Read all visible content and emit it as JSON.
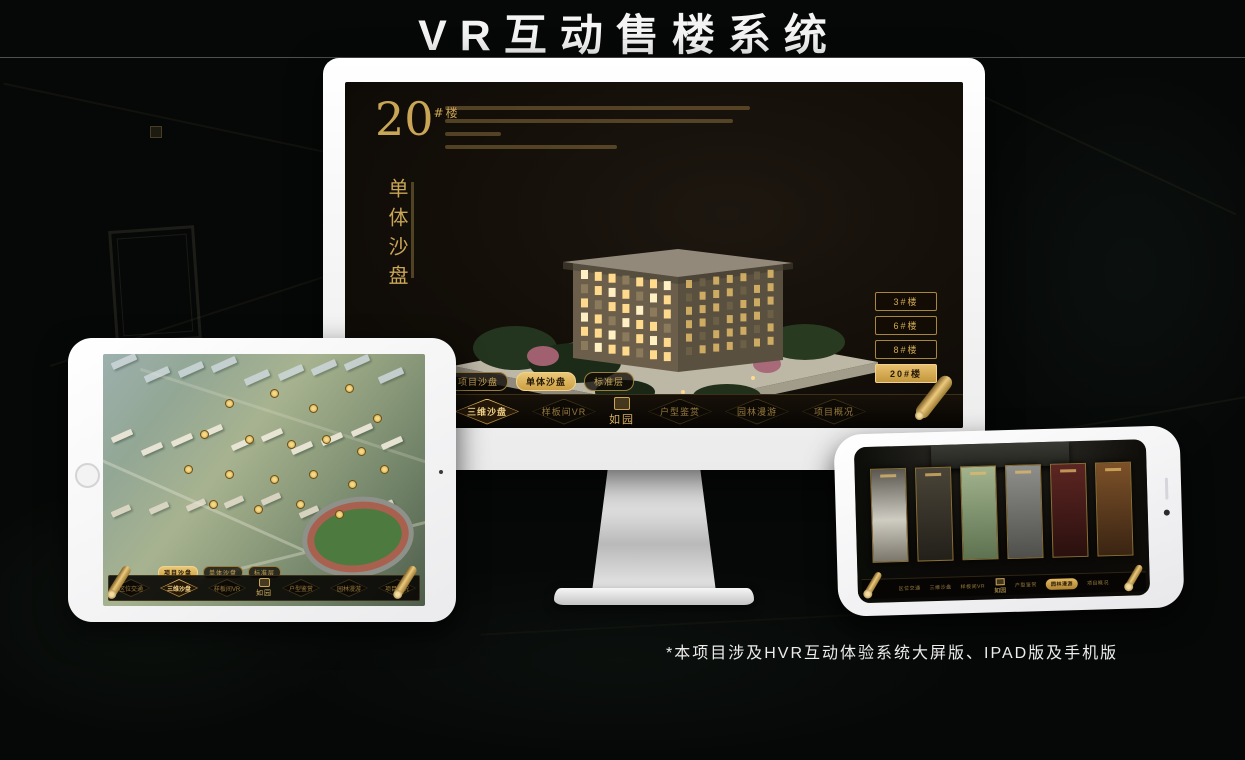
{
  "page": {
    "title": "VR互动售楼系统",
    "footnote": "*本项目涉及HVR互动体验系统大屏版、IPAD版及手机版"
  },
  "colors": {
    "gold": "#d2a94f",
    "gold_active_bg": "#e8bf6e",
    "screen_bg": "#130e08"
  },
  "monitor": {
    "headline_number": "20",
    "headline_suffix": "#楼",
    "headline_vertical": "单体沙盘",
    "building_buttons": [
      {
        "label": "3#楼",
        "active": false
      },
      {
        "label": "6#楼",
        "active": false
      },
      {
        "label": "8#楼",
        "active": false
      },
      {
        "label": "20#楼",
        "active": true
      }
    ],
    "view_tabs": [
      {
        "label": "项目沙盘",
        "active": false
      },
      {
        "label": "单体沙盘",
        "active": true
      },
      {
        "label": "标准层",
        "active": false
      }
    ],
    "nav": {
      "logo": "如园",
      "items": [
        {
          "label": "区位交通",
          "active": false
        },
        {
          "label": "三维沙盘",
          "active": true
        },
        {
          "label": "样板间VR",
          "active": false
        },
        {
          "label": "户型鉴赏",
          "active": false
        },
        {
          "label": "园林漫游",
          "active": false
        },
        {
          "label": "项目概况",
          "active": false
        }
      ]
    }
  },
  "tablet": {
    "view_tabs": [
      {
        "label": "项目沙盘",
        "active": true
      },
      {
        "label": "单体沙盘",
        "active": false
      },
      {
        "label": "标准层",
        "active": false
      }
    ],
    "nav": {
      "logo": "如园",
      "items": [
        {
          "label": "区位交通",
          "active": false
        },
        {
          "label": "三维沙盘",
          "active": true
        },
        {
          "label": "样板间VR",
          "active": false
        },
        {
          "label": "户型鉴赏",
          "active": false
        },
        {
          "label": "园林漫游",
          "active": false
        },
        {
          "label": "项目概况",
          "active": false
        }
      ]
    }
  },
  "phone": {
    "nav": {
      "logo": "如园",
      "items": [
        {
          "label": "区位交通",
          "active": false
        },
        {
          "label": "三维沙盘",
          "active": false
        },
        {
          "label": "样板间VR",
          "active": false
        },
        {
          "label": "户型鉴赏",
          "active": false
        },
        {
          "label": "园林漫游",
          "active": true
        },
        {
          "label": "项目概况",
          "active": false
        }
      ]
    }
  }
}
